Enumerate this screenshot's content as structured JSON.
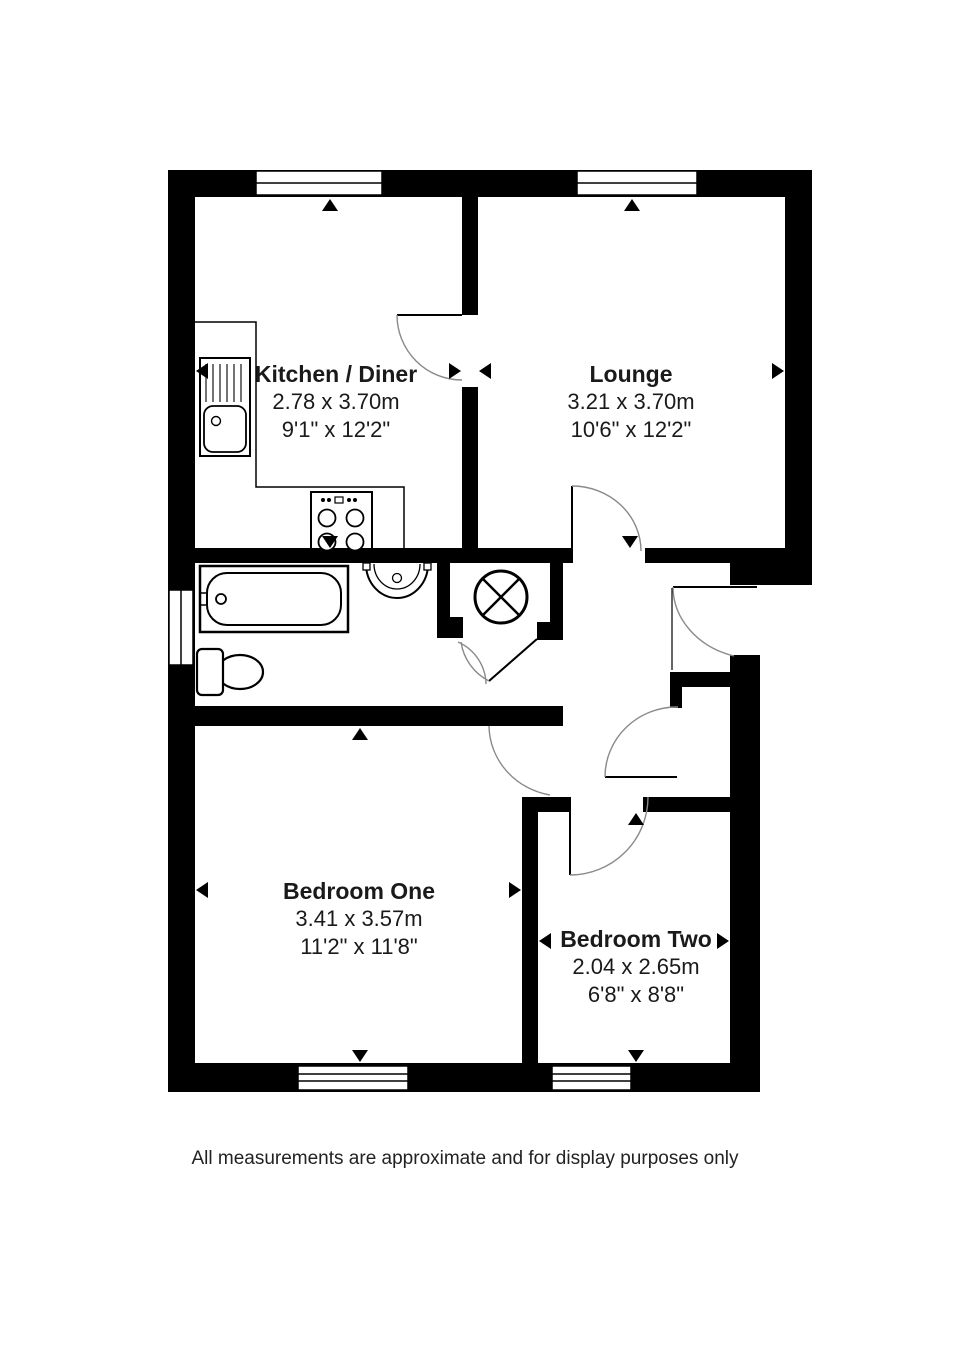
{
  "title": "Two bedroom flat floorplan",
  "footer_note": "All measurements are approximate and for display purposes only",
  "rooms": {
    "kitchen": {
      "name": "Kitchen / Diner",
      "metric": "2.78 x 3.70m",
      "imperial": "9'1\" x 12'2\""
    },
    "lounge": {
      "name": "Lounge",
      "metric": "3.21 x 3.70m",
      "imperial": "10'6\" x 12'2\""
    },
    "bedroom_one": {
      "name": "Bedroom One",
      "metric": "3.41 x 3.57m",
      "imperial": "11'2\" x 11'8\""
    },
    "bedroom_two": {
      "name": "Bedroom Two",
      "metric": "2.04 x 2.65m",
      "imperial": "6'8\" x 8'8\""
    }
  },
  "fixtures": [
    "bath",
    "toilet",
    "wash-basin",
    "hot-water-cylinder",
    "kitchen-sink",
    "hob",
    "worktop"
  ],
  "windows_count": 5,
  "doors_count": 8,
  "colors": {
    "wall": "#000000",
    "background": "#ffffff",
    "door_arc": "#8a8a8a",
    "text": "#1a1a1a"
  }
}
